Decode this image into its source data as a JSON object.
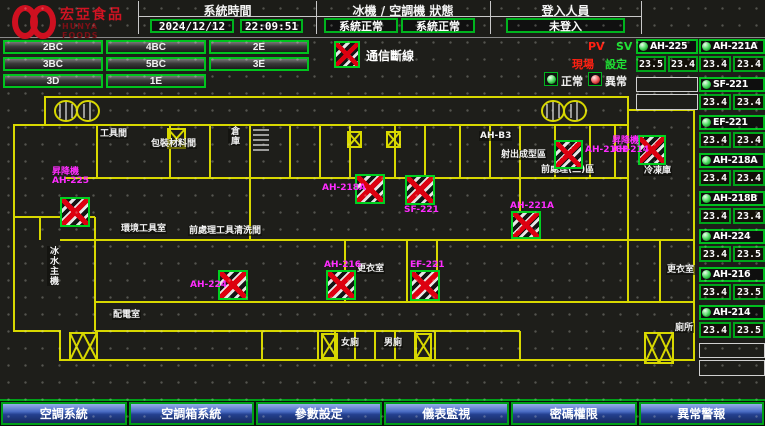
{
  "header": {
    "logo_title": "宏亞食品",
    "logo_subtitle": "HUNYA FOODS",
    "time_label": "系統時間",
    "date": "2024/12/12",
    "time": "22:09:51",
    "status_label": "冰機 / 空調機 狀態",
    "chiller_status": "系統正常",
    "ahu_status": "系統正常",
    "login_label": "登入人員",
    "login_status": "未登入",
    "login_button": "登入/登出"
  },
  "floors": [
    "2BC",
    "4BC",
    "2E",
    "3BC",
    "5BC",
    "3E",
    "3D",
    "1E"
  ],
  "legend": {
    "comm_loss": "通信斷線",
    "normal": "正常",
    "abnormal": "異常",
    "pv": "PV",
    "sv": "SV",
    "pv_label": "現場",
    "sv_label": "設定"
  },
  "units_top": [
    {
      "name": "AH-225",
      "pv": "23.5",
      "sv": "23.4",
      "status": "normal"
    }
  ],
  "units_top_empty_slots": 1,
  "units_right": [
    {
      "name": "AH-221A",
      "pv": "23.4",
      "sv": "23.4",
      "status": "normal"
    },
    {
      "name": "SF-221",
      "pv": "23.4",
      "sv": "23.4",
      "status": "normal"
    },
    {
      "name": "EF-221",
      "pv": "23.4",
      "sv": "23.4",
      "status": "normal"
    },
    {
      "name": "AH-218A",
      "pv": "23.4",
      "sv": "23.4",
      "status": "normal"
    },
    {
      "name": "AH-218B",
      "pv": "23.4",
      "sv": "23.4",
      "status": "normal"
    },
    {
      "name": "AH-224",
      "pv": "23.4",
      "sv": "23.5",
      "status": "normal"
    },
    {
      "name": "AH-216",
      "pv": "23.4",
      "sv": "23.5",
      "status": "normal"
    },
    {
      "name": "AH-214",
      "pv": "23.4",
      "sv": "23.5",
      "status": "normal"
    }
  ],
  "units_right_empty_slots": 1,
  "map": {
    "devices": [
      {
        "name": "AH-225",
        "label_lines": [
          "昇降機",
          "AH-225"
        ],
        "lx": 52,
        "ly": 168,
        "bx": 60,
        "by": 197,
        "bw": 30,
        "bh": 30,
        "state": "comm-loss"
      },
      {
        "name": "AH-224",
        "label_lines": [
          "AH-224"
        ],
        "lx": 190,
        "ly": 281,
        "bx": 218,
        "by": 270,
        "bw": 30,
        "bh": 30,
        "state": "comm-loss"
      },
      {
        "name": "AH-218A",
        "label_lines": [
          "AH-218A"
        ],
        "lx": 322,
        "ly": 184,
        "bx": 355,
        "by": 174,
        "bw": 30,
        "bh": 30,
        "state": "comm-loss"
      },
      {
        "name": "SF-221",
        "label_lines": [
          "SF-221"
        ],
        "lx": 404,
        "ly": 206,
        "bx": 405,
        "by": 175,
        "bw": 30,
        "bh": 30,
        "state": "comm-loss"
      },
      {
        "name": "AH-218B",
        "label_lines": [
          "AH-218B"
        ],
        "lx": 585,
        "ly": 146,
        "bx": 554,
        "by": 140,
        "bw": 29,
        "bh": 29,
        "state": "comm-loss"
      },
      {
        "name": "AH-214",
        "label_lines": [
          "昇降機",
          "AH-214"
        ],
        "lx": 612,
        "ly": 137,
        "bx": 638,
        "by": 135,
        "bw": 28,
        "bh": 30,
        "state": "comm-loss"
      },
      {
        "name": "AH-221A",
        "label_lines": [
          "AH-221A"
        ],
        "lx": 510,
        "ly": 202,
        "bx": 511,
        "by": 211,
        "bw": 30,
        "bh": 28,
        "state": "comm-loss"
      },
      {
        "name": "AH-216",
        "label_lines": [
          "AH-216"
        ],
        "lx": 324,
        "ly": 261,
        "bx": 326,
        "by": 270,
        "bw": 30,
        "bh": 30,
        "state": "comm-loss"
      },
      {
        "name": "EF-221",
        "label_lines": [
          "EF-221"
        ],
        "lx": 410,
        "ly": 261,
        "bx": 410,
        "by": 270,
        "bw": 30,
        "bh": 31,
        "state": "comm-loss"
      }
    ],
    "rooms": [
      {
        "text": "工具間",
        "x": 99,
        "y": 129,
        "vert": false
      },
      {
        "text": "包裝材料間",
        "x": 150,
        "y": 139,
        "vert": false
      },
      {
        "text": "倉庫",
        "x": 228,
        "y": 126,
        "vert": true
      },
      {
        "text": "AH-B3",
        "x": 479,
        "y": 131,
        "vert": false
      },
      {
        "text": "射出成型區",
        "x": 500,
        "y": 150,
        "vert": false
      },
      {
        "text": "前處理(二)區",
        "x": 540,
        "y": 165,
        "vert": false
      },
      {
        "text": "冷凍庫",
        "x": 643,
        "y": 166,
        "vert": false
      },
      {
        "text": "環境工具室",
        "x": 120,
        "y": 224,
        "vert": false
      },
      {
        "text": "前處理工具清洗間",
        "x": 188,
        "y": 226,
        "vert": false
      },
      {
        "text": "冰水主機",
        "x": 47,
        "y": 246,
        "vert": true
      },
      {
        "text": "配電室",
        "x": 112,
        "y": 310,
        "vert": false
      },
      {
        "text": "更衣室",
        "x": 356,
        "y": 264,
        "vert": false
      },
      {
        "text": "女廁",
        "x": 340,
        "y": 338,
        "vert": false
      },
      {
        "text": "男廁",
        "x": 383,
        "y": 338,
        "vert": false
      },
      {
        "text": "更衣室",
        "x": 666,
        "y": 265,
        "vert": false
      },
      {
        "text": "廁所",
        "x": 674,
        "y": 323,
        "vert": false
      }
    ]
  },
  "nav": [
    "空調系統",
    "空調箱系統",
    "參數設定",
    "儀表監視",
    "密碼權限",
    "異常警報"
  ],
  "colors": {
    "accent_green": "#00c41e",
    "alarm_red": "#dd0010",
    "device_magenta": "#ff2cff",
    "wall_yellow": "#d8d800",
    "nav_blue": "#24408f"
  }
}
